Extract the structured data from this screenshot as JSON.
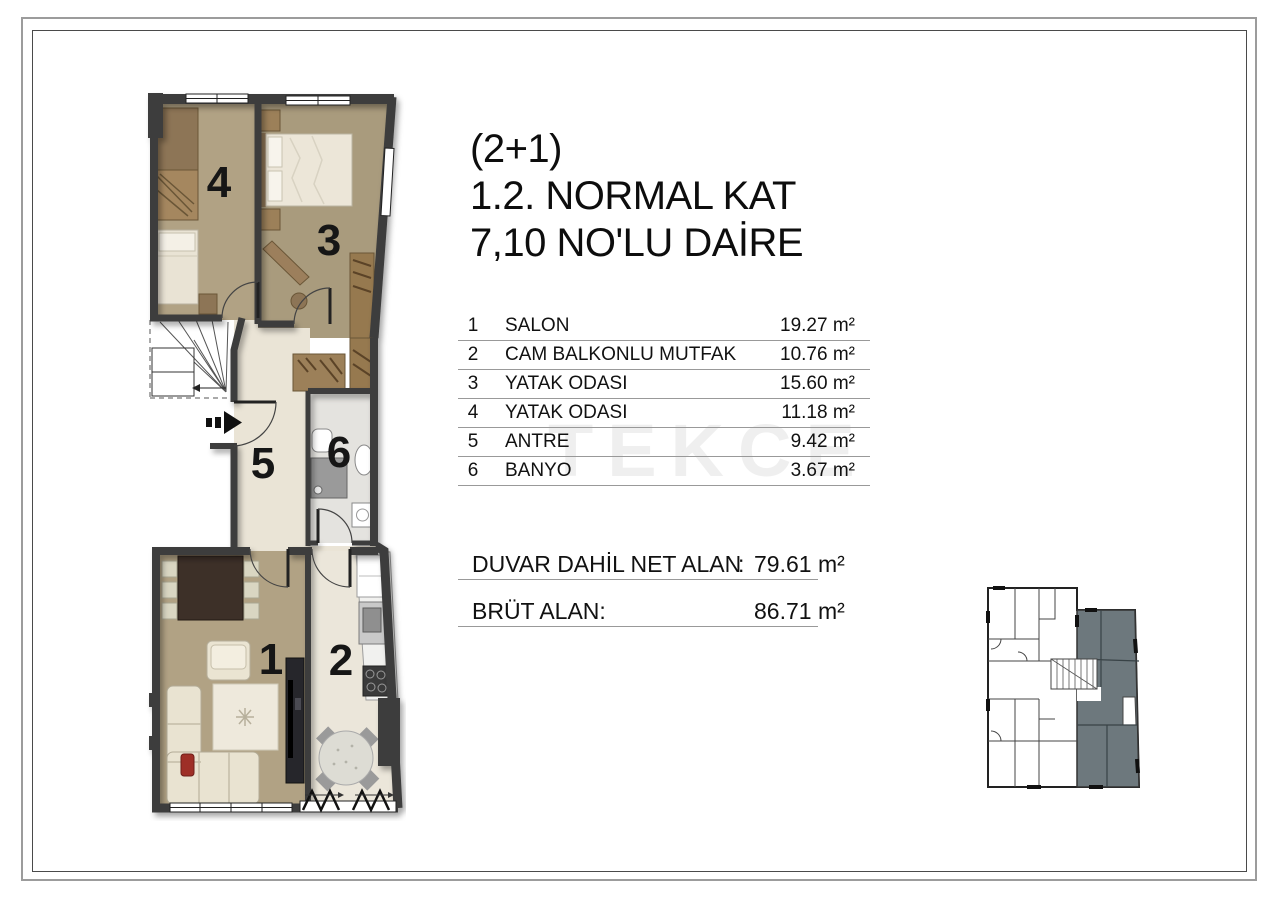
{
  "header": {
    "type_label": "(2+1)",
    "floor_label": "1.2. NORMAL KAT",
    "unit_label": "7,10 NO'LU DAİRE"
  },
  "rooms_table": {
    "rows": [
      {
        "no": "1",
        "name": "SALON",
        "area": "19.27 m²"
      },
      {
        "no": "2",
        "name": "CAM BALKONLU MUTFAK",
        "area": "10.76 m²"
      },
      {
        "no": "3",
        "name": "YATAK ODASI",
        "area": "15.60 m²"
      },
      {
        "no": "4",
        "name": "YATAK ODASI",
        "area": "11.18 m²"
      },
      {
        "no": "5",
        "name": "ANTRE",
        "area": "9.42 m²"
      },
      {
        "no": "6",
        "name": "BANYO",
        "area": "3.67 m²"
      }
    ]
  },
  "totals": {
    "net_label": "DUVAR DAHİL NET ALAN",
    "net_sep": ":",
    "net_value": "79.61 m²",
    "gross_label": "BRÜT ALAN:",
    "gross_value": "86.71 m²"
  },
  "floorplan": {
    "room_numbers": {
      "salon": "1",
      "kitchen": "2",
      "bedroom_3": "3",
      "bedroom_4": "4",
      "hall": "5",
      "bath": "6"
    }
  },
  "watermark": "TEKCE",
  "colors": {
    "wall": "#3e3e3e",
    "wood_floor": "#b1a284",
    "tile_floor": "#eae4d6",
    "keyplan_unit_highlight": "#6d787d",
    "frame_outer": "#9c9c9c",
    "frame_inner": "#4a4a4a"
  }
}
